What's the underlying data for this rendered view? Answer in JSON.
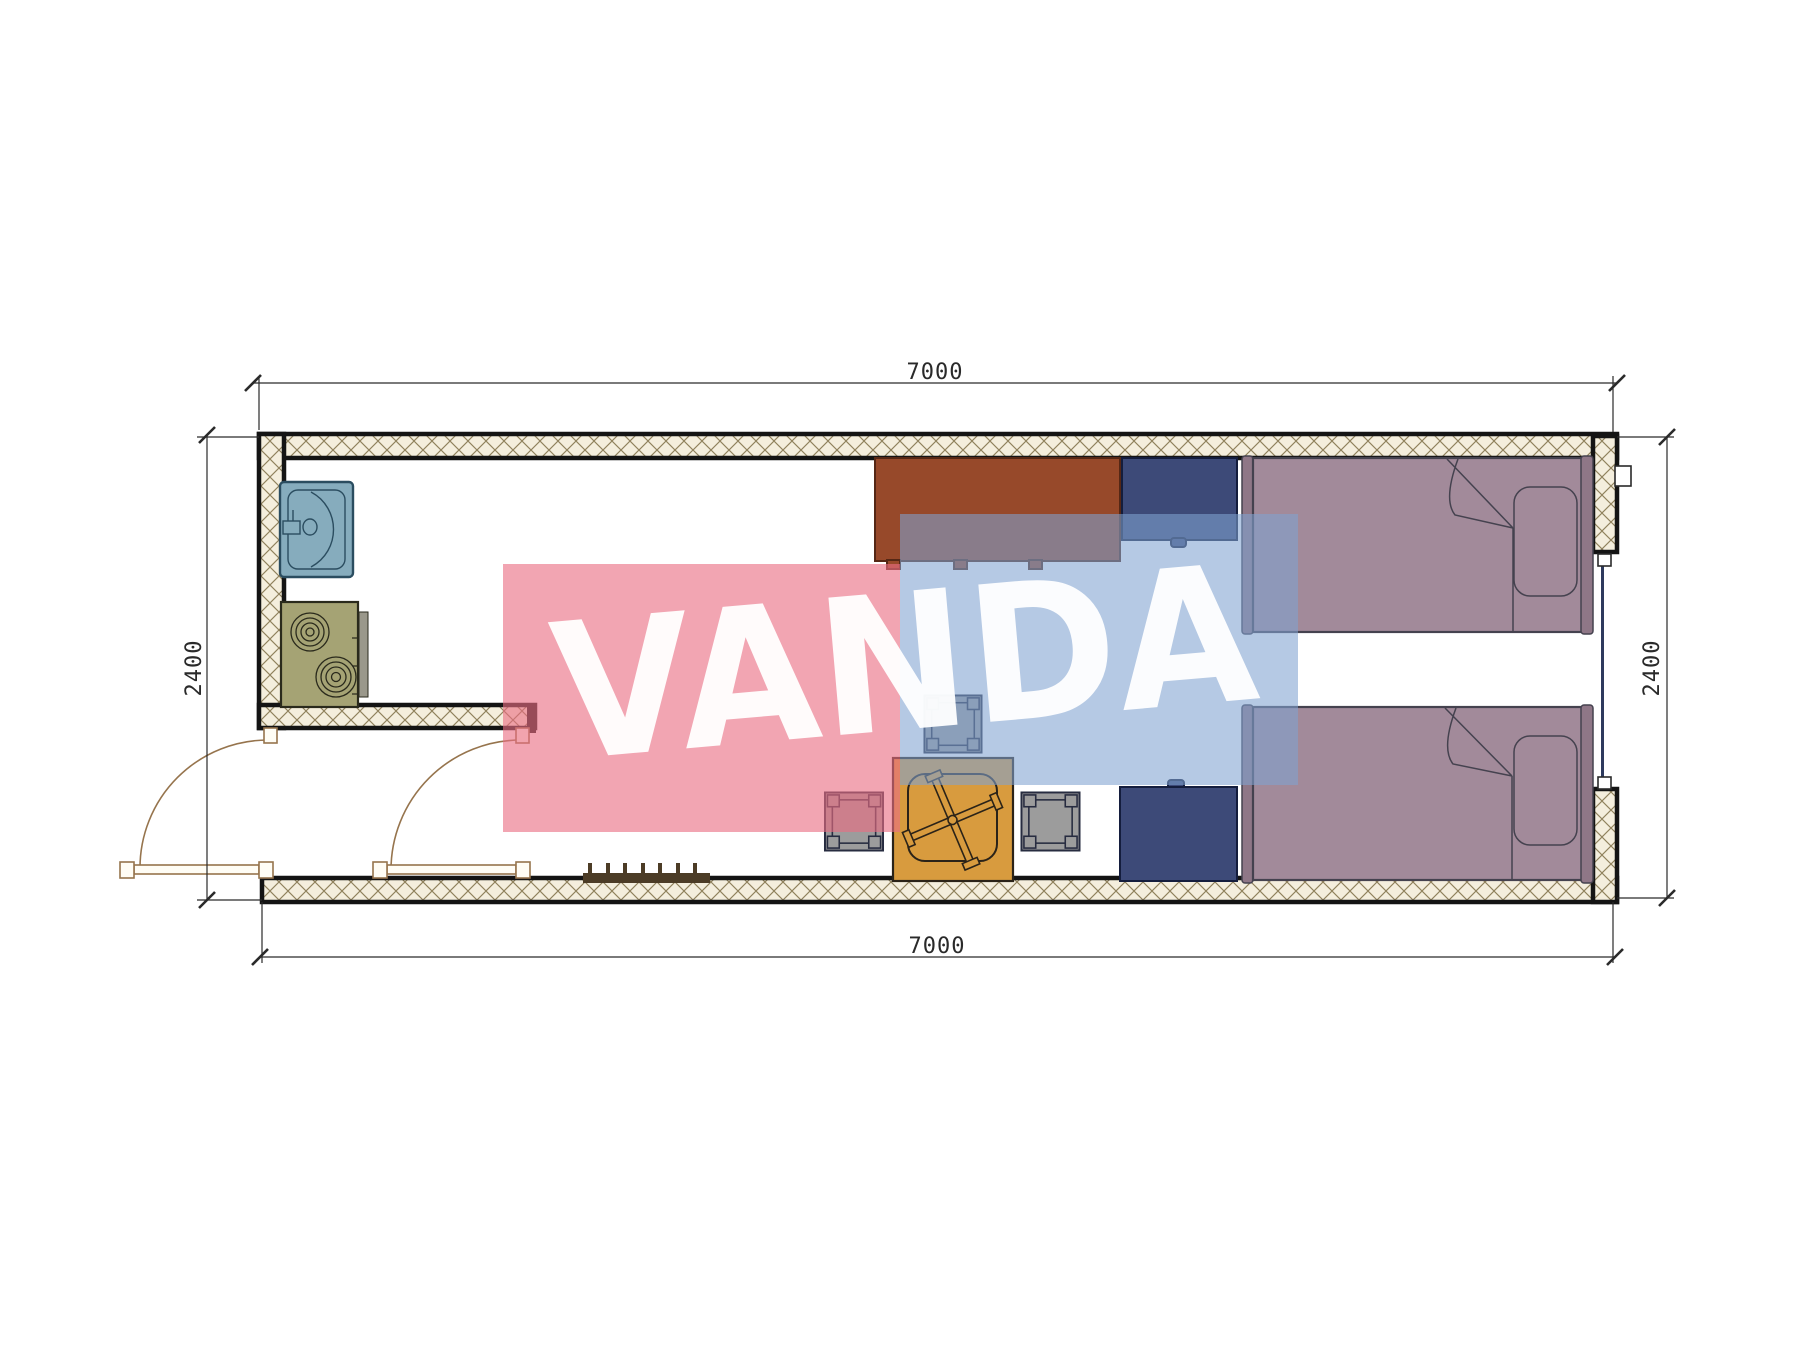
{
  "document": {
    "type": "architectural-floor-plan",
    "background": "#ffffff"
  },
  "watermark": {
    "text": "VANDA"
  },
  "dimensions": {
    "top": "7000",
    "bottom": "7000",
    "left": "2400",
    "right": "2400"
  },
  "palette": {
    "wall-line": "#141414",
    "hatch-bg": "#f4eedd",
    "hatch-line": "#8f815c",
    "sink-fill": "#86acbd",
    "sink-line": "#2b4d60",
    "stove-fill": "#a5a374",
    "stove-line": "#2a2a1c",
    "stove-rail": "#9a988b",
    "desk-fill": "#97492a",
    "desk-line": "#552715",
    "navy-fill": "#3d4a78",
    "navy-line": "#141d3d",
    "bed-fill": "#a28a9a",
    "bed-frame": "#8f7787",
    "bed-line": "#45424f",
    "table-fill": "#d89b3e",
    "table-line": "#2b2318",
    "stool-fill": "#9c9c9c",
    "stool-line": "#272c40",
    "door-line": "#96744d",
    "dim-line": "#2a2a2a",
    "radiator": "#4c3c26",
    "window-line": "#2e3a5e",
    "watermark-pink": "rgba(234,110,130,0.62)",
    "watermark-blue": "rgba(128,162,208,0.58)",
    "watermark-text": "rgba(255,255,255,0.95)"
  },
  "furniture": [
    {
      "name": "sink"
    },
    {
      "name": "stove"
    },
    {
      "name": "desk"
    },
    {
      "name": "wardrobe-top"
    },
    {
      "name": "bed-top"
    },
    {
      "name": "bed-bottom"
    },
    {
      "name": "table-with-chair"
    },
    {
      "name": "stool-top"
    },
    {
      "name": "stool-left"
    },
    {
      "name": "stool-right"
    },
    {
      "name": "wardrobe-bottom"
    },
    {
      "name": "radiator"
    },
    {
      "name": "door-left"
    },
    {
      "name": "door-right"
    },
    {
      "name": "window-right-wall"
    }
  ]
}
